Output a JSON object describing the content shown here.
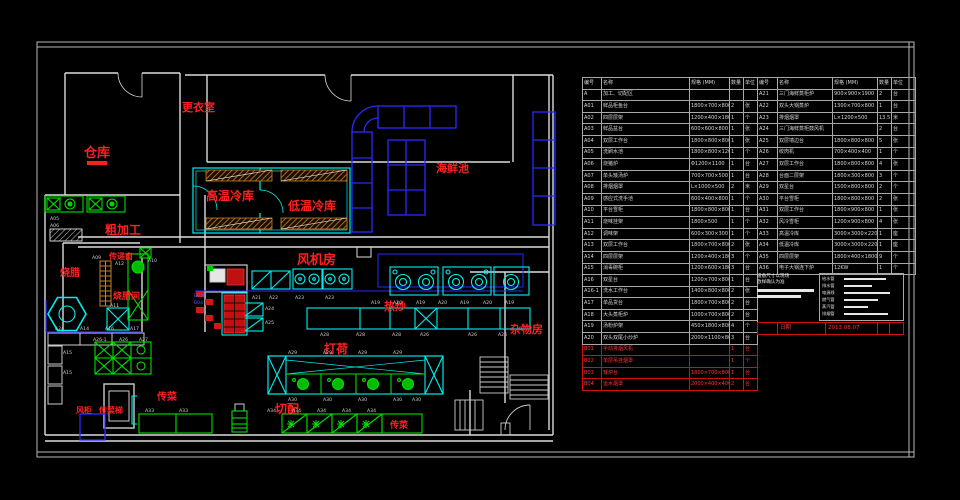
{
  "colors": {
    "wall": "#dcdcdc",
    "red": "#ff2020",
    "cyan": "#00f0f0",
    "green": "#00e000",
    "blue": "#2a2aff",
    "orange": "#c8812a",
    "table_grid": "#a8a8a8",
    "red_row": "#d01010"
  },
  "plan": {
    "room_labels": [
      {
        "text": "仓库",
        "x": 84,
        "y": 157,
        "size": 13
      },
      {
        "text": "更衣室",
        "x": 182,
        "y": 111,
        "size": 11
      },
      {
        "text": "高温冷库",
        "x": 206,
        "y": 200,
        "size": 12
      },
      {
        "text": "低温冷库",
        "x": 288,
        "y": 210,
        "size": 12
      },
      {
        "text": "海鲜池",
        "x": 436,
        "y": 172,
        "size": 11
      },
      {
        "text": "风机房",
        "x": 297,
        "y": 264,
        "size": 13
      },
      {
        "text": "粗加工",
        "x": 105,
        "y": 234,
        "size": 12
      },
      {
        "text": "传递窗",
        "x": 109,
        "y": 259,
        "size": 8
      },
      {
        "text": "烧腊",
        "x": 60,
        "y": 276,
        "size": 10
      },
      {
        "text": "烧腊间",
        "x": 113,
        "y": 299,
        "size": 9
      },
      {
        "text": "热炒",
        "x": 384,
        "y": 310,
        "size": 11
      },
      {
        "text": "打荷",
        "x": 324,
        "y": 353,
        "size": 12
      },
      {
        "text": "切配",
        "x": 275,
        "y": 413,
        "size": 12
      },
      {
        "text": "传菜",
        "x": 157,
        "y": 400,
        "size": 10
      },
      {
        "text": "风柜",
        "x": 76,
        "y": 413,
        "size": 8
      },
      {
        "text": "传菜梯",
        "x": 99,
        "y": 413,
        "size": 8
      },
      {
        "text": "传菜",
        "x": 390,
        "y": 428,
        "size": 9
      },
      {
        "text": "杂物房",
        "x": 510,
        "y": 333,
        "size": 11
      }
    ],
    "tags": [
      {
        "t": "A05",
        "x": 50,
        "y": 220
      },
      {
        "t": "A06",
        "x": 50,
        "y": 227
      },
      {
        "t": "A09",
        "x": 92,
        "y": 259
      },
      {
        "t": "A10",
        "x": 148,
        "y": 262
      },
      {
        "t": "A12",
        "x": 115,
        "y": 265
      },
      {
        "t": "B03",
        "x": 194,
        "y": 297,
        "c": "#5555ff"
      },
      {
        "t": "B04",
        "x": 194,
        "y": 304,
        "c": "#5555ff"
      },
      {
        "t": "A11",
        "x": 110,
        "y": 307
      },
      {
        "t": "A21",
        "x": 252,
        "y": 299
      },
      {
        "t": "A22",
        "x": 269,
        "y": 299
      },
      {
        "t": "A23",
        "x": 295,
        "y": 299
      },
      {
        "t": "A23",
        "x": 325,
        "y": 299
      },
      {
        "t": "A19",
        "x": 371,
        "y": 304
      },
      {
        "t": "A20",
        "x": 393,
        "y": 304
      },
      {
        "t": "A19",
        "x": 416,
        "y": 304
      },
      {
        "t": "A20",
        "x": 438,
        "y": 304
      },
      {
        "t": "A19",
        "x": 460,
        "y": 304
      },
      {
        "t": "A20",
        "x": 483,
        "y": 304
      },
      {
        "t": "A19",
        "x": 505,
        "y": 304
      },
      {
        "t": "A24",
        "x": 265,
        "y": 310
      },
      {
        "t": "A25",
        "x": 265,
        "y": 324
      },
      {
        "t": "A28",
        "x": 320,
        "y": 336
      },
      {
        "t": "A28",
        "x": 356,
        "y": 336
      },
      {
        "t": "A28",
        "x": 392,
        "y": 336
      },
      {
        "t": "A26",
        "x": 420,
        "y": 336
      },
      {
        "t": "A26",
        "x": 468,
        "y": 336
      },
      {
        "t": "A26",
        "x": 498,
        "y": 336
      },
      {
        "t": "A29",
        "x": 288,
        "y": 354
      },
      {
        "t": "A29",
        "x": 323,
        "y": 354
      },
      {
        "t": "A29",
        "x": 358,
        "y": 354
      },
      {
        "t": "A29",
        "x": 393,
        "y": 354
      },
      {
        "t": "A30",
        "x": 288,
        "y": 401
      },
      {
        "t": "A30",
        "x": 323,
        "y": 401
      },
      {
        "t": "A30",
        "x": 358,
        "y": 401
      },
      {
        "t": "A30",
        "x": 393,
        "y": 401
      },
      {
        "t": "A30",
        "x": 412,
        "y": 401
      },
      {
        "t": "A34",
        "x": 267,
        "y": 412
      },
      {
        "t": "A34",
        "x": 292,
        "y": 412
      },
      {
        "t": "A34",
        "x": 317,
        "y": 412
      },
      {
        "t": "A34",
        "x": 342,
        "y": 412
      },
      {
        "t": "A34",
        "x": 367,
        "y": 412
      },
      {
        "t": "A24",
        "x": 55,
        "y": 330
      },
      {
        "t": "A14",
        "x": 80,
        "y": 330
      },
      {
        "t": "A16",
        "x": 105,
        "y": 330
      },
      {
        "t": "A17",
        "x": 130,
        "y": 330
      },
      {
        "t": "A26-1",
        "x": 93,
        "y": 341
      },
      {
        "t": "A26",
        "x": 119,
        "y": 341
      },
      {
        "t": "A27",
        "x": 139,
        "y": 341
      },
      {
        "t": "A15",
        "x": 63,
        "y": 354
      },
      {
        "t": "A15",
        "x": 63,
        "y": 374
      },
      {
        "t": "A33",
        "x": 145,
        "y": 412
      },
      {
        "t": "A33",
        "x": 179,
        "y": 412
      }
    ]
  },
  "tables": {
    "left": {
      "headers": [
        "编号",
        "名称",
        "规格 (MM)",
        "数量",
        "单位"
      ],
      "rows": [
        {
          "c": [
            "A",
            "加工、切配区",
            "",
            "",
            ""
          ]
        },
        {
          "c": [
            "A01",
            "鲜品柜鱼台",
            "1800×700×800",
            "2",
            "张"
          ]
        },
        {
          "c": [
            "A02",
            "四层层架",
            "1200×400×1800",
            "1",
            "个"
          ]
        },
        {
          "c": [
            "A03",
            "鲜品盆台",
            "600×600×800",
            "1",
            "张"
          ]
        },
        {
          "c": [
            "A04",
            "双层工作台",
            "1800×800×800",
            "1",
            "张"
          ]
        },
        {
          "c": [
            "A05",
            "洗刷水池",
            "1800×800×1200",
            "1",
            "个"
          ]
        },
        {
          "c": [
            "A06",
            "烧猪炉",
            "Φ1200×1100",
            "1",
            "台"
          ]
        },
        {
          "c": [
            "A07",
            "单头矮汤炉",
            "700×700×500",
            "1",
            "台"
          ]
        },
        {
          "c": [
            "A08",
            "排烟烟罩",
            "L×1000×500",
            "2",
            "米"
          ]
        },
        {
          "c": [
            "A09",
            "感应式洗手池",
            "600×400×800",
            "1",
            "个"
          ]
        },
        {
          "c": [
            "A10",
            "平台雪柜",
            "1800×800×800",
            "1",
            "台"
          ]
        },
        {
          "c": [
            "A11",
            "烧味挂架",
            "1800×500",
            "1",
            "个"
          ]
        },
        {
          "c": [
            "A12",
            "调味架",
            "600×300×300",
            "1",
            "个"
          ]
        },
        {
          "c": [
            "A13",
            "双层工作台",
            "1800×700×800",
            "2",
            "张"
          ]
        },
        {
          "c": [
            "A14",
            "四层层架",
            "1200×400×1800",
            "3",
            "个"
          ]
        },
        {
          "c": [
            "A15",
            "消毒碗柜",
            "1200×600×1800",
            "3",
            "台"
          ]
        },
        {
          "c": [
            "A16",
            "双星台",
            "1200×700×800",
            "1",
            "台"
          ]
        },
        {
          "c": [
            "A16-1",
            "洗水工作台",
            "1400×800×800",
            "2",
            "张"
          ]
        },
        {
          "c": [
            "A17",
            "单品货台",
            "1800×700×800",
            "2",
            "台"
          ]
        },
        {
          "c": [
            "A18",
            "大头蒸柜炉",
            "1000×700×800",
            "2",
            "台"
          ]
        },
        {
          "c": [
            "A19",
            "汤粉炉架",
            "450×1800×800",
            "4",
            "个"
          ]
        },
        {
          "c": [
            "A20",
            "双头双尾小炒炉",
            "2000×1100×800",
            "3",
            "台"
          ]
        },
        {
          "c": [
            "B01",
            "手动排烟风机",
            "",
            "1",
            "台"
          ],
          "red": true
        },
        {
          "c": [
            "B02",
            "单层吊挂烟罩",
            "",
            "1",
            "个"
          ],
          "red": true
        },
        {
          "c": [
            "B03",
            "矮炉台",
            "1800×700×800",
            "1",
            "台"
          ],
          "red": true
        },
        {
          "c": [
            "B04",
            "运水烟罩",
            "2000×400×400",
            "2",
            "台"
          ],
          "red": true
        }
      ]
    },
    "right": {
      "headers": [
        "编号",
        "名称",
        "规格 (MM)",
        "数量",
        "单位"
      ],
      "rows": [
        {
          "c": [
            "A21",
            "三门海鲜蒸柜炉",
            "900×900×1900",
            "2",
            "台"
          ]
        },
        {
          "c": [
            "A22",
            "双头大锅蒸炉",
            "1300×700×800",
            "1",
            "台"
          ]
        },
        {
          "c": [
            "A23",
            "排烟烟罩",
            "L×1200×500",
            "13.5",
            "米"
          ]
        },
        {
          "c": [
            "A24",
            "三门海鲜蒸柜鼓风机",
            "",
            "2",
            "台"
          ]
        },
        {
          "c": [
            "A25",
            "双层墙边台",
            "1800×800×800",
            "5",
            "张"
          ]
        },
        {
          "c": [
            "A26",
            "绞肉机",
            "700×400×400",
            "1",
            "个"
          ]
        },
        {
          "c": [
            "A27",
            "双层工作台",
            "1800×800×800",
            "4",
            "张"
          ]
        },
        {
          "c": [
            "A28",
            "台面二层架",
            "1800×300×800",
            "3",
            "个"
          ]
        },
        {
          "c": [
            "A29",
            "双星台",
            "1500×800×800",
            "2",
            "个"
          ]
        },
        {
          "c": [
            "A30",
            "平台雪柜",
            "1800×800×800",
            "2",
            "张"
          ]
        },
        {
          "c": [
            "A31",
            "双层工作台",
            "1800×900×800",
            "1",
            "张"
          ]
        },
        {
          "c": [
            "A32",
            "风冷雪柜",
            "1200×900×800",
            "4",
            "张"
          ]
        },
        {
          "c": [
            "A33",
            "高温冷库",
            "3000×3000×2200",
            "1",
            "座"
          ]
        },
        {
          "c": [
            "A34",
            "低温冷库",
            "3000×3000×2200",
            "1",
            "座"
          ]
        },
        {
          "c": [
            "A35",
            "四层层架",
            "1800×400×1800",
            "9",
            "个"
          ]
        },
        {
          "c": [
            "A36",
            "电子大锅连下炉",
            "12KW",
            "1",
            "个"
          ]
        }
      ],
      "notes": [
        "设备尺寸以现场",
        "放样确认为准"
      ],
      "legend": [
        {
          "label": "给水管"
        },
        {
          "label": "排水管"
        },
        {
          "label": "电源线"
        },
        {
          "label": "燃气管"
        },
        {
          "label": "蒸汽管"
        },
        {
          "label": "排烟管"
        }
      ],
      "footer": {
        "cells": [
          "",
          "日期",
          "2013.08.07",
          "",
          ""
        ]
      }
    }
  }
}
